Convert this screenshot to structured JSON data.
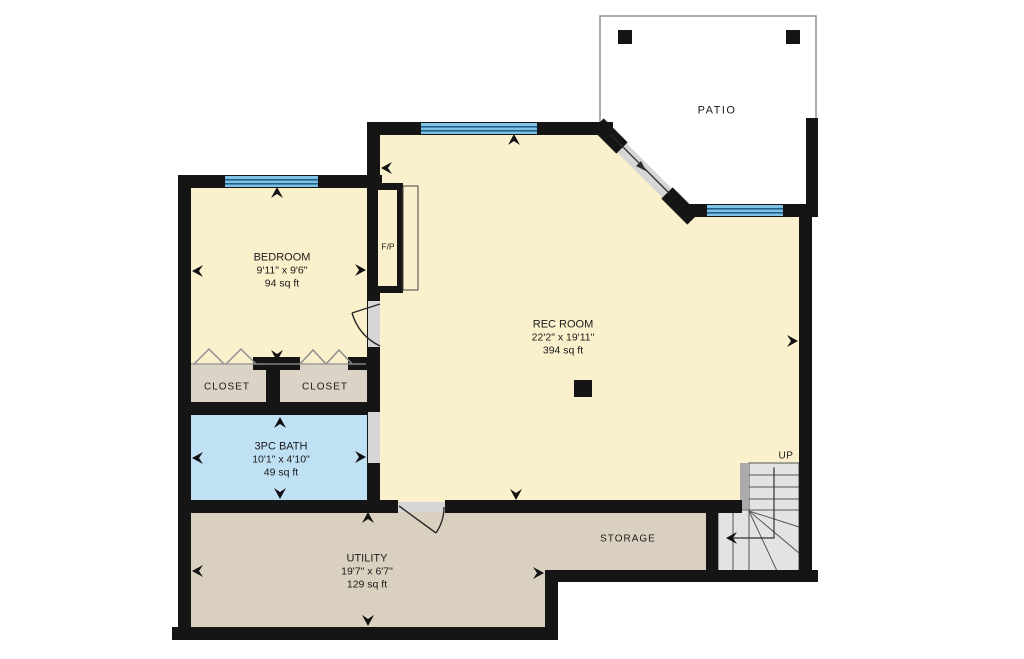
{
  "title": "Basement floor plan",
  "colors": {
    "wall": "#151515",
    "cream": "#FAF0CC",
    "closet-tan": "#DAD3C6",
    "utility-tan": "#D9D0BF",
    "bath-blue": "#C0E0F4",
    "window-blue": "#7FC2E4",
    "window-line": "#20608C",
    "stair-gray": "#E3E3E3",
    "stair-strip": "#ABABAB",
    "stair-line": "#555555",
    "opening": "#D6D6D6",
    "patio-border": "#909090",
    "door-line": "#2A2A2A",
    "chevron": "#8E8E8E",
    "text": "#1A1A1A",
    "arrow": "#111111"
  },
  "rooms": {
    "bedroom": {
      "name": "BEDROOM",
      "dims": "9'11\" x 9'6\"",
      "area": "94 sq ft"
    },
    "rec_room": {
      "name": "REC ROOM",
      "dims": "22'2\" x 19'11\"",
      "area": "394 sq ft"
    },
    "bath": {
      "name": "3PC BATH",
      "dims": "10'1\" x 4'10\"",
      "area": "49 sq ft"
    },
    "utility": {
      "name": "UTILITY",
      "dims": "19'7\" x 6'7\"",
      "area": "129 sq ft"
    },
    "closet_left": {
      "name": "CLOSET"
    },
    "closet_right": {
      "name": "CLOSET"
    },
    "storage": {
      "name": "STORAGE"
    },
    "patio": {
      "name": "PATIO"
    }
  },
  "annotations": {
    "stairs_up": "UP",
    "fireplace": "F/P"
  }
}
